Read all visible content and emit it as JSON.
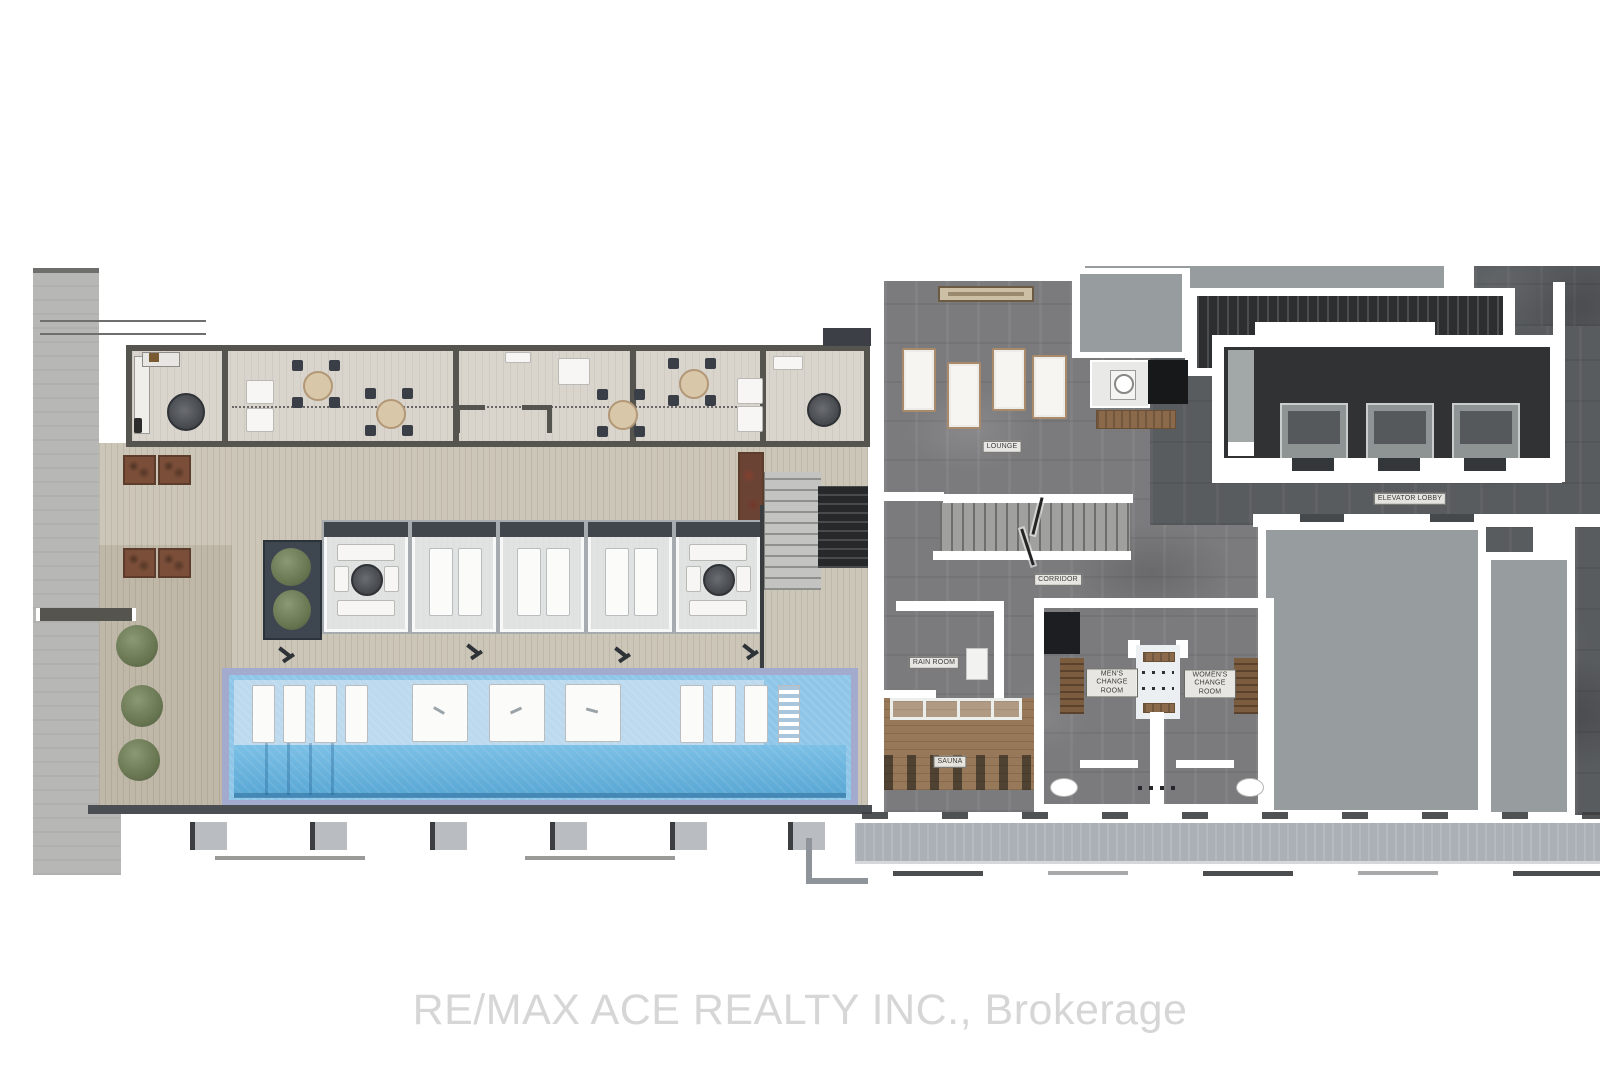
{
  "floor_plan": {
    "rooms": {
      "lounge": "LOUNGE",
      "corridor": "CORRIDOR",
      "rain_room": "RAIN ROOM",
      "sauna": "SAUNA",
      "mens_change_room": "MEN'S CHANGE ROOM",
      "womens_change_room": "WOMEN'S CHANGE ROOM",
      "elevator_lobby": "ELEVATOR LOBBY"
    }
  },
  "watermark": "RE/MAX ACE REALTY INC., Brokerage",
  "colors": {
    "deck": "#ccc6b9",
    "concrete": "#b7b7b5",
    "wall-dark": "#55544f",
    "stone": "#7b7b7d",
    "stone-dark": "#595c5f",
    "grey-room": "#979d9e",
    "pool-shallow": "#bcd9ee",
    "pool-mid": "#8fc6e8",
    "pool-deep": "#58a7d4",
    "pool-border": "#a2abce",
    "sidewalk": "#aab0b6",
    "planter": "#7a4e38",
    "foliage": "#66744f",
    "wood": "#8a6a4a",
    "locker-wood": "#7c5c3e",
    "sauna-wood": "#97795a"
  }
}
